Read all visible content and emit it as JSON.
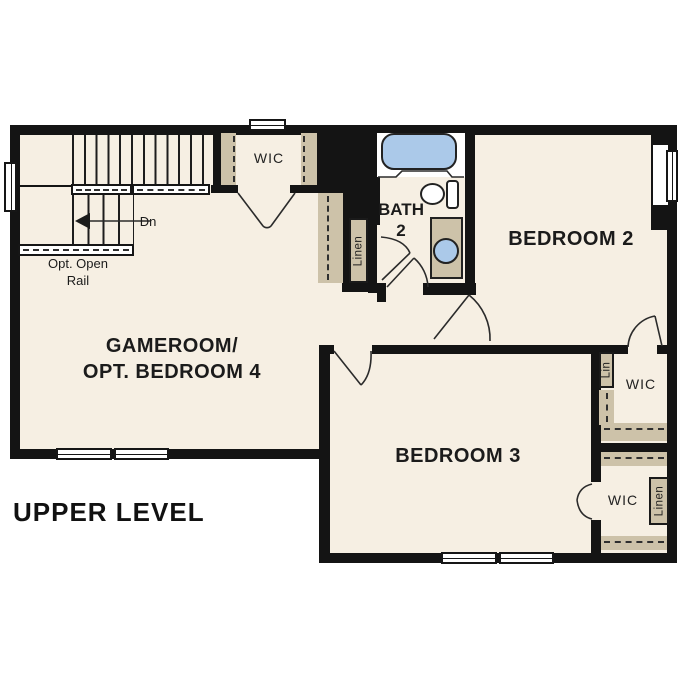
{
  "title": "UPPER LEVEL",
  "rooms": {
    "gameroom": {
      "line1": "GAMEROOM/",
      "line2": "OPT. BEDROOM 4"
    },
    "bedroom2": {
      "label": "BEDROOM 2"
    },
    "bedroom3": {
      "label": "BEDROOM 3"
    },
    "bath": {
      "line1": "BATH",
      "line2": "2"
    }
  },
  "closets": {
    "wic_top": "WIC",
    "wic_bedroom2": "WIC",
    "wic_bedroom3": "WIC",
    "lin": "Lin",
    "linen_hall": "Linen",
    "linen_wic": "Linen"
  },
  "stairs": {
    "down_label": "Dn",
    "open_rail_line1": "Opt. Open",
    "open_rail_line2": "Rail"
  },
  "colors": {
    "floor": "#f6efe3",
    "cabinet_tan": "#cdc2a9",
    "fixture_blue": "#abc9e9",
    "wall": "#141414"
  }
}
